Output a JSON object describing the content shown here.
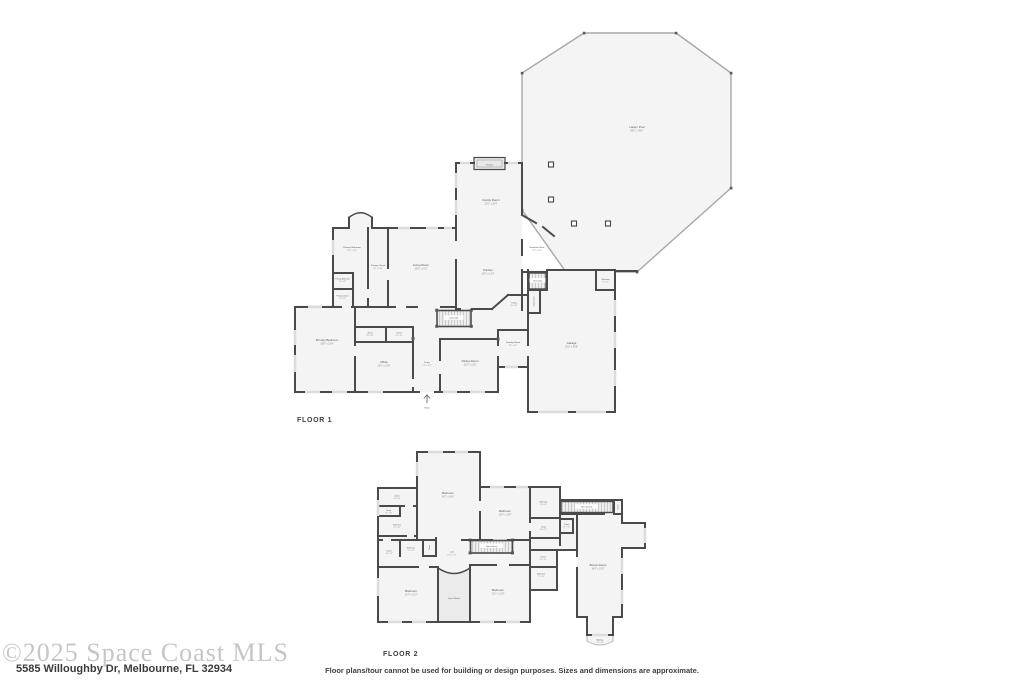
{
  "floor1": {
    "label": "FLOOR 1",
    "rooms": [
      {
        "name": "Lanai / Pool",
        "dims": "56'0\" x 48'0\""
      },
      {
        "name": "Fireplace",
        "dims": ""
      },
      {
        "name": "Family Room",
        "dims": "21'6\" x 20'4\""
      },
      {
        "name": "Breakfast Nook",
        "dims": "11'8\" x 10'2\""
      },
      {
        "name": "Kitchen",
        "dims": "15'6\" x 13'4\""
      },
      {
        "name": "Primary Bathroom",
        "dims": "12'2\" x 11'6\""
      },
      {
        "name": "Primary Closet",
        "dims": "6'8\" x 13'4\""
      },
      {
        "name": "Living Room",
        "dims": "19'8\" x 16'2\""
      },
      {
        "name": "Primary Bathroom",
        "dims": "5'2\" x 4'8\""
      },
      {
        "name": "Primary Closet",
        "dims": "5'2\" x 5'6\""
      },
      {
        "name": "Primary Bedroom",
        "dims": "16'8\" x 15'4\""
      },
      {
        "name": "Closet",
        "dims": "4'2\" x 3'8\""
      },
      {
        "name": "Closet",
        "dims": "4'2\" x 3'8\""
      },
      {
        "name": "Office",
        "dims": "13'6\" x 12'8\""
      },
      {
        "name": "Foyer",
        "dims": "7'4\" x 12'6\""
      },
      {
        "name": "Dining Room",
        "dims": "13'2\" x 12'6\""
      },
      {
        "name": "Laundry Room",
        "dims": "8'4\" x 7'6\""
      },
      {
        "name": "Pantry",
        "dims": "4'6\" x 5'2\""
      },
      {
        "name": "Stairs (Up)",
        "dims": ""
      },
      {
        "name": "Stairs (Up)",
        "dims": ""
      },
      {
        "name": "Utility Closet",
        "dims": ""
      },
      {
        "name": "Bathroom",
        "dims": "5'4\" x 5'0\""
      },
      {
        "name": "Garage",
        "dims": "25'0\" x 29'6\""
      },
      {
        "name": "Entry",
        "dims": ""
      }
    ]
  },
  "floor2": {
    "label": "FLOOR 2",
    "rooms": [
      {
        "name": "Bedroom",
        "dims": "14'2\" x 18'6\""
      },
      {
        "name": "Closet",
        "dims": "6'4\" x 4'2\""
      },
      {
        "name": "Closet",
        "dims": "3'2\" x 2'8\""
      },
      {
        "name": "Bathroom",
        "dims": "6'4\" x 5'2\""
      },
      {
        "name": "Bedroom",
        "dims": "12'4\" x 11'6\""
      },
      {
        "name": "Bathroom",
        "dims": "5'6\" x 8'2\""
      },
      {
        "name": "Closet",
        "dims": "5'6\" x 4'2\""
      },
      {
        "name": "Closet",
        "dims": "4'2\" x 3'6\""
      },
      {
        "name": "Stairs (Down)",
        "dims": ""
      },
      {
        "name": "Closet",
        "dims": ""
      },
      {
        "name": "Closet",
        "dims": "4'8\" x 6'2\""
      },
      {
        "name": "Bathroom",
        "dims": "5'2\" x 6'2\""
      },
      {
        "name": "Closet",
        "dims": ""
      },
      {
        "name": "Loft",
        "dims": "11'6\" x 7'4\""
      },
      {
        "name": "Stairs (Down)",
        "dims": ""
      },
      {
        "name": "Closet",
        "dims": "5'4\" x 3'8\""
      },
      {
        "name": "Bathroom",
        "dims": "7'2\" x 5'4\""
      },
      {
        "name": "Bonus Room",
        "dims": "16'4\" x 22'6\""
      },
      {
        "name": "Bedroom",
        "dims": "13'4\" x 12'2\""
      },
      {
        "name": "Open To Below",
        "dims": ""
      },
      {
        "name": "Bedroom",
        "dims": "13'2\" x 12'4\""
      },
      {
        "name": "Balcony",
        "dims": "7'0\" x 3'2\""
      }
    ]
  },
  "footer": {
    "watermark": "©2025 Space Coast MLS",
    "address": "5585 Willoughby Dr, Melbourne, FL 32934",
    "disclaimer": "Floor plans/tour cannot be used for building or design purposes. Sizes and dimensions are approximate."
  },
  "colors": {
    "wall": "#4a4a4a",
    "room_fill": "#f4f4f5",
    "lanai_stroke": "#a8a8a8",
    "label_text": "#4f4f4f",
    "dims_text": "#8d8d8d",
    "watermark_text": "#c6c6c6"
  }
}
